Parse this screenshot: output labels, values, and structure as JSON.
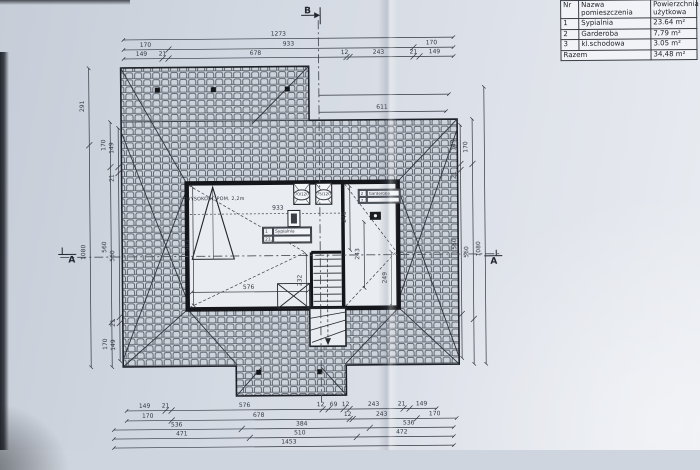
{
  "table": {
    "h_nr": "Nr",
    "h_name": "Nazwa pomieszczenia",
    "h_area": "Powierzchnia użytkowa",
    "rows": [
      {
        "nr": "1",
        "name": "Sypialnia",
        "area": "23.64 m²"
      },
      {
        "nr": "2",
        "name": "Garderoba",
        "area": "7,79 m²"
      },
      {
        "nr": "3",
        "name": "kl.schodowa",
        "area": "3.05 m²"
      }
    ],
    "total_label": "Razem",
    "total_area": "34,48 m²"
  },
  "sections": {
    "b": "B",
    "a_left": "A",
    "a_right": "A"
  },
  "dims": {
    "t1": "1273",
    "t2a": "170",
    "t2b": "933",
    "t2c": "170",
    "t3a": "149",
    "t3b": "21",
    "t3c": "678",
    "t3d": "12",
    "t3e": "243",
    "t3f": "21",
    "t3g": "149",
    "r611": "611",
    "l_291": "291",
    "l_1080": "1080",
    "l_170t": "170",
    "l_560a": "560",
    "l_170b": "170",
    "l_149t": "149",
    "l_21t": "21",
    "l_560b": "560",
    "l_21b": "21",
    "l_149b": "149",
    "r_149": "149",
    "r_21": "21",
    "r_170": "170",
    "r_560a": "560",
    "r_560b": "560",
    "r_1080": "1080",
    "b1a": "149",
    "b1b": "21",
    "b1c": "576",
    "b1d": "12",
    "b1e": "69",
    "b1f": "12",
    "b1g": "243",
    "b1h": "21",
    "b1i": "149",
    "b2a": "170",
    "b2b": "678",
    "b2c": "12",
    "b2d": "243",
    "b2e": "170",
    "b3a": "536",
    "b3b": "384",
    "b3c": "536",
    "b4a": "471",
    "b4b": "510",
    "b4c": "472",
    "b5": "1453",
    "i563": "563",
    "i576": "576",
    "i232": "232",
    "i245": "245",
    "i249": "249",
    "i243": "243",
    "i933": "933"
  },
  "plan": {
    "height_note": "WYSOKOŚĆ POM. 2,2m",
    "window1": "70/120",
    "window2": "75/120",
    "tag1": {
      "nr": "1",
      "name": "Sypialnia",
      "area": "23,64 m²",
      "finish": ""
    },
    "tag2": {
      "nr": "2",
      "name": "Garderoba",
      "area": "7,79 m²",
      "finish": ""
    }
  },
  "colors": {
    "paper": "#d6dbe3",
    "line": "#2b2f38",
    "wall": "#14161b",
    "tile_fill": "#ccd2d9",
    "tile_stroke": "#565c66"
  }
}
